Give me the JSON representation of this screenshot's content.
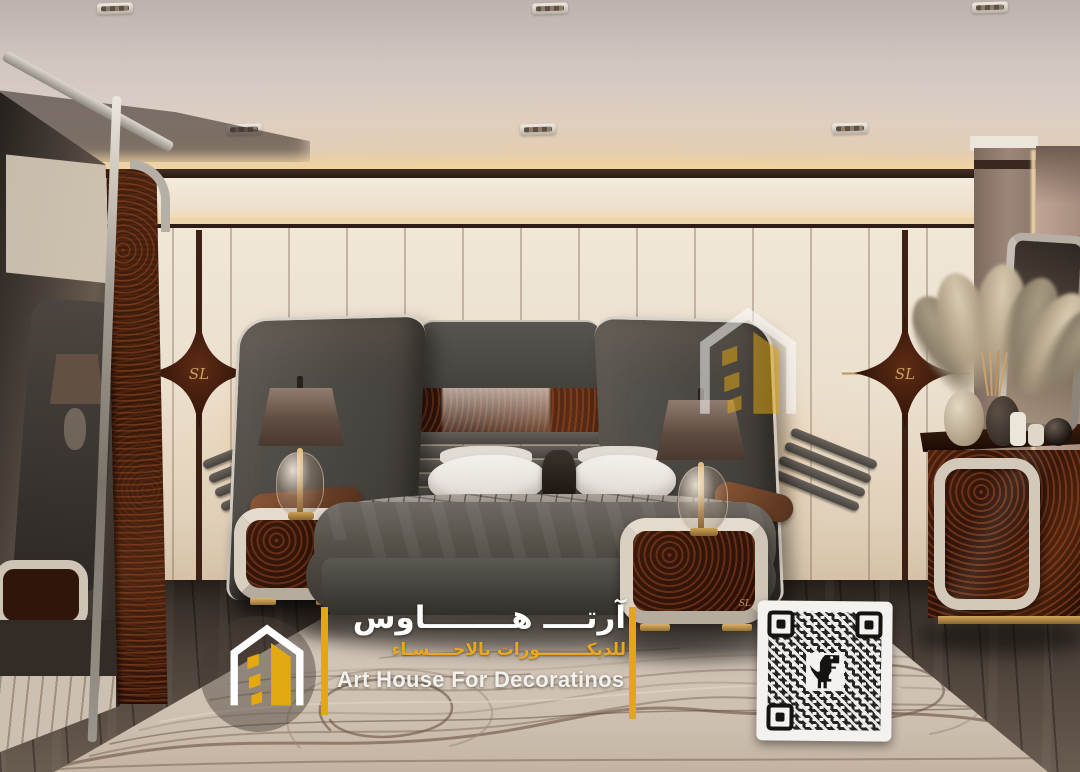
{
  "brand": {
    "icon": "art-house-logo",
    "arabic_title": "آرتــــ هــــــــاوس",
    "arabic_subtitle": "للديكــــــــورات بالاحــــسـاء",
    "english_title": "Art House  For Decoratinos",
    "accent_color": "#e2a715"
  },
  "watermark": {
    "center_icon": "art-house-logo",
    "qr_center_icon": "dino-icon"
  },
  "wall_monogram": {
    "text": "SL",
    "color": "#c9a05c"
  },
  "palette": {
    "wall": "#ece3d4",
    "ceiling": "#d6cbc5",
    "burl_wood": "#3a1a0e",
    "headboard_gray": "#4c4843",
    "floor_wood": "#4a423a",
    "rug": "#cfc4b8",
    "cove_glow": "#f6d9a6"
  }
}
